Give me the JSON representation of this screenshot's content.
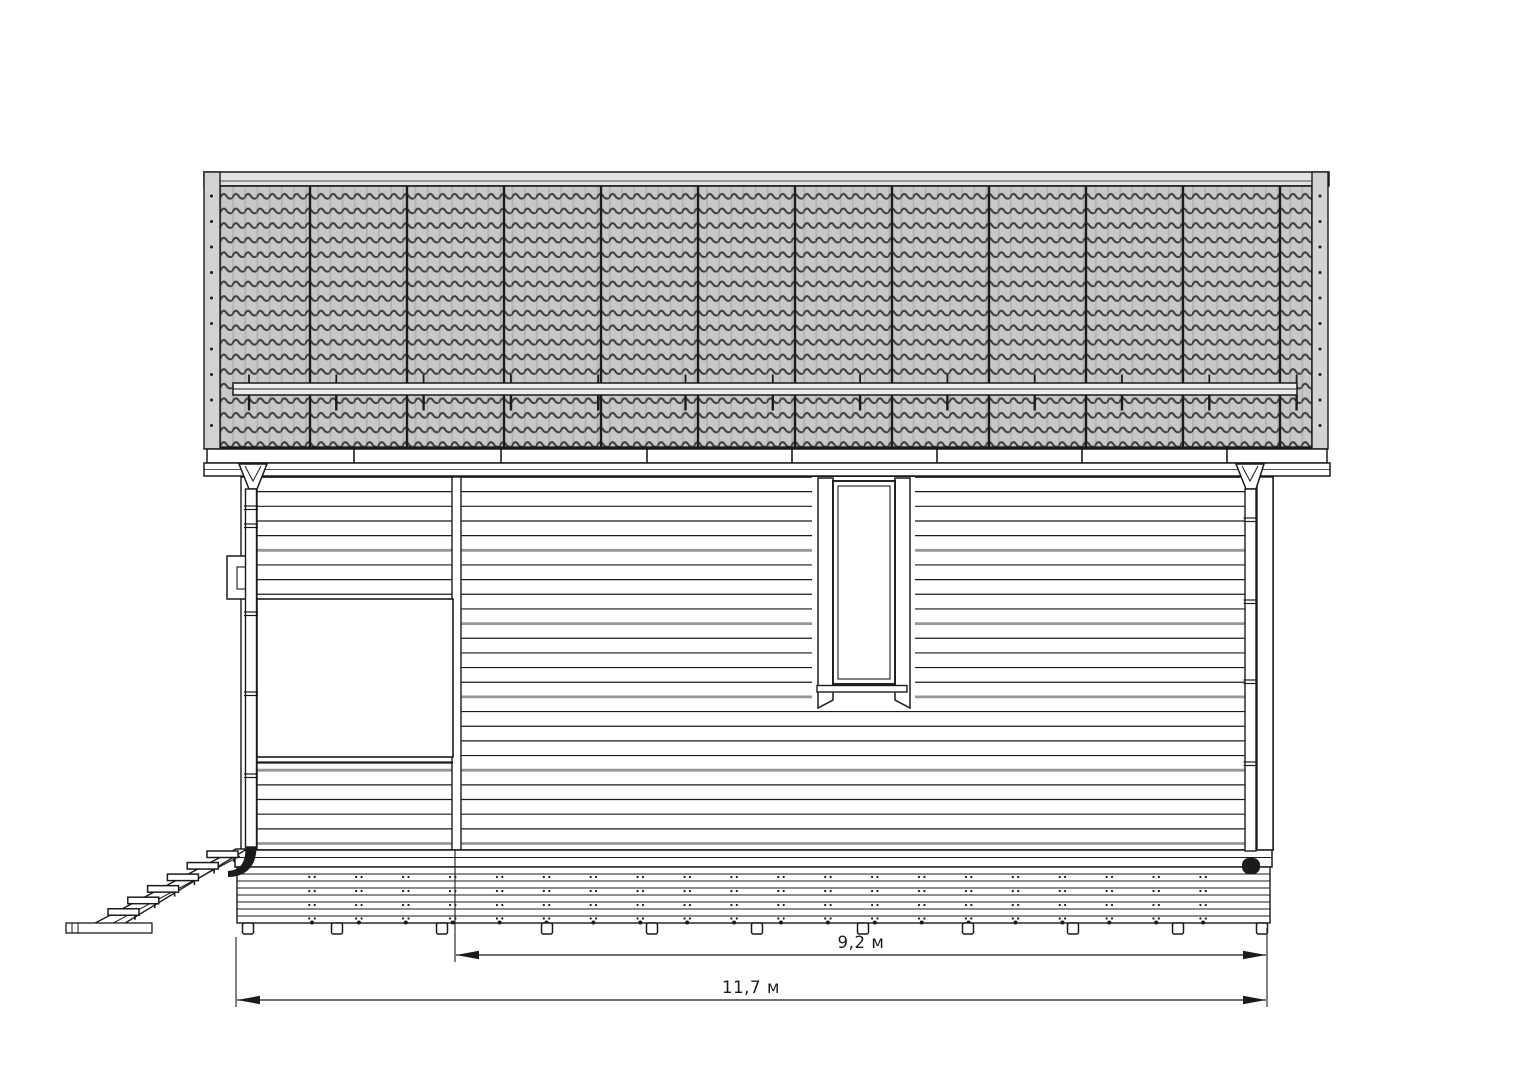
{
  "title": "Side elevation drawing of a house",
  "labels": {
    "dim_main": "9,2 м",
    "dim_overall": "11,7 м"
  },
  "colors": {
    "background": "#ffffff",
    "line": "#1b1b1b",
    "siding_shadow": "#979797",
    "tile_fill": "#c8c8c8",
    "tile_wave": "#3d3d3d",
    "tile_rib": "#b5b5b5",
    "barge_fill": "#d3d3d3",
    "ridge_fill": "#e3e3e3",
    "guard_fill": "#ededed"
  },
  "structure": {
    "stair_step_count": 6,
    "roof_tile_row_count": 18,
    "roof_sheet_seam_count": 11,
    "snow_guard_bracket_count": 13,
    "fascia_joint_count": 7,
    "siding_board_count": 25,
    "foundation_pile_count": 11,
    "window_count": 1,
    "downspout_count": 2
  }
}
